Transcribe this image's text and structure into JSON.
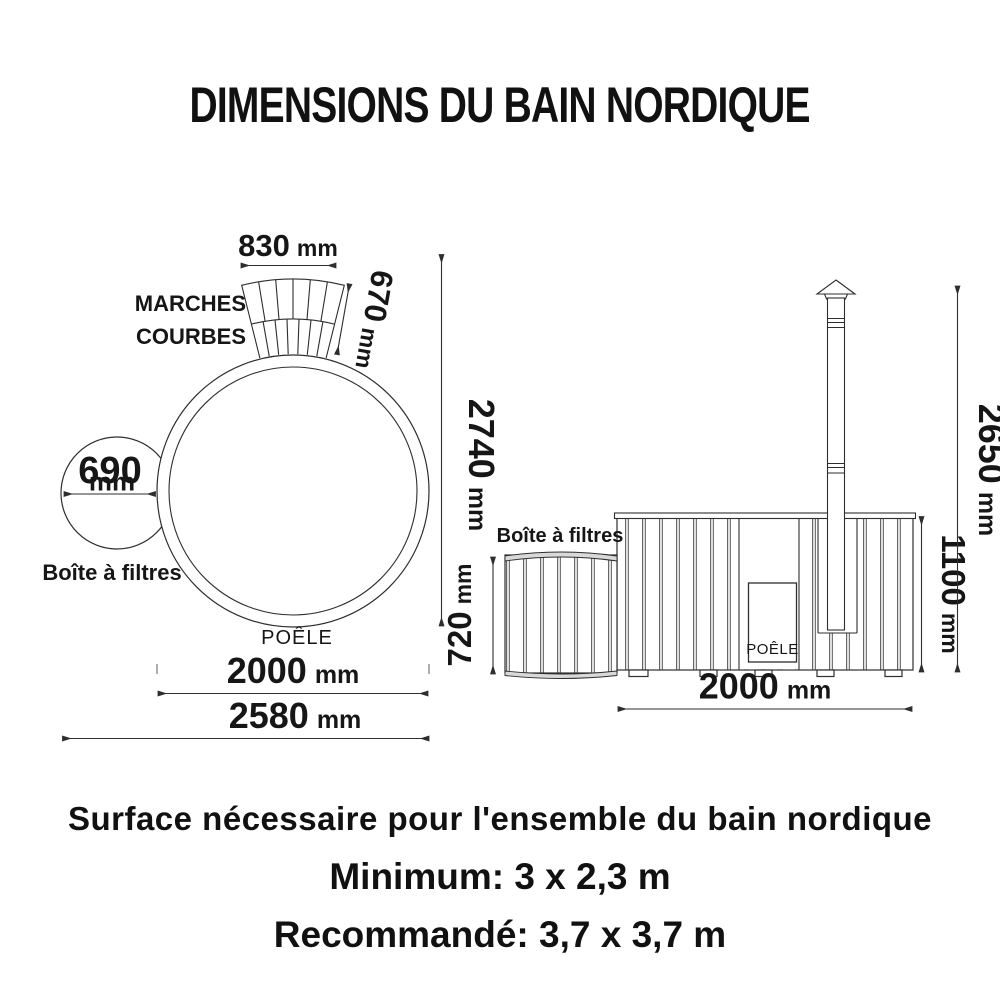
{
  "title": "DIMENSIONS DU BAIN NORDIQUE",
  "top_view": {
    "steps_label_line1": "MARCHES",
    "steps_label_line2": "COURBES",
    "steps_width": {
      "value": "830",
      "unit": "mm"
    },
    "steps_depth": {
      "value": "670",
      "unit": "mm"
    },
    "filter_diameter": {
      "value": "690",
      "unit": "mm"
    },
    "filter_label": "Boîte à filtres",
    "stove_label": "POÊLE",
    "tub_diameter": {
      "value": "2000",
      "unit": "mm"
    },
    "overall_width": {
      "value": "2580",
      "unit": "mm"
    },
    "overall_length": {
      "value": "2740",
      "unit": "mm"
    }
  },
  "side_view": {
    "filter_label": "Boîte à filtres",
    "filter_height": {
      "value": "720",
      "unit": "mm"
    },
    "stove_label": "POÊLE",
    "tub_width": {
      "value": "2000",
      "unit": "mm"
    },
    "tub_height": {
      "value": "1100",
      "unit": "mm"
    },
    "total_height": {
      "value": "2650",
      "unit": "mm"
    }
  },
  "footer": {
    "surface_title": "Surface nécessaire pour l'ensemble du bain nordique",
    "minimum": "Minimum: 3 x 2,3 m",
    "recommended": "Recommandé: 3,7 x 3,7 m"
  },
  "colors": {
    "ink": "#161616",
    "line": "#2e2e2e",
    "shade": "#dddddd"
  }
}
